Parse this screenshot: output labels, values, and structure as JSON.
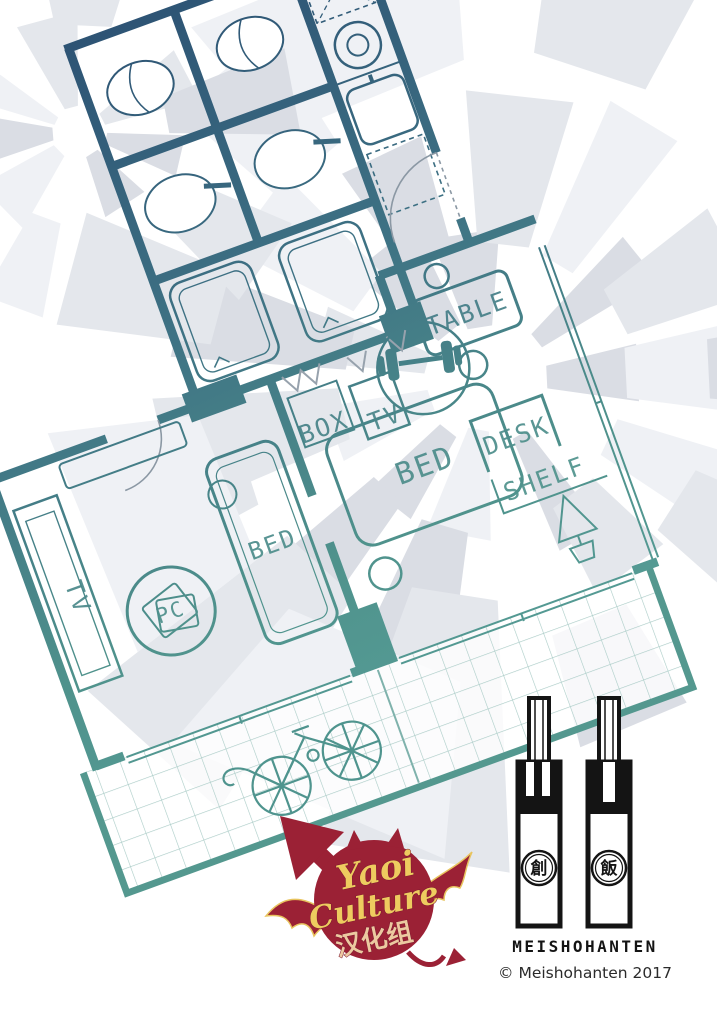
{
  "page": {
    "background": "#ffffff"
  },
  "background": {
    "colors": [
      "#eff1f5",
      "#e4e7ec",
      "#dadde4"
    ],
    "pinwheels": [
      {
        "cx": 488,
        "cy": 380,
        "rings": [
          [
            60,
            175,
            11
          ],
          [
            150,
            300,
            13
          ],
          [
            250,
            450,
            11
          ],
          [
            340,
            540,
            8
          ]
        ]
      },
      {
        "cx": 78,
        "cy": 132,
        "rings": [
          [
            26,
            110,
            9
          ],
          [
            100,
            235,
            9
          ]
        ]
      }
    ]
  },
  "floorplan": {
    "rotation_deg": -20,
    "colors": {
      "wall_top": "#2d5374",
      "wall_mid": "#3e7284",
      "wall_teal": "#4f928c",
      "wall_bottom": "#5aa39c",
      "balcony_grid": "#a9cbc6",
      "fixture_gray": "#97a2ad"
    },
    "labels": {
      "table": "TABLE",
      "desk": "DESK",
      "shelf": "SHELF",
      "bed": "BED",
      "box": "BOX",
      "tv": "TV",
      "pc": "PC"
    },
    "icons": {
      "toilet": "toilet-bowl-ellipse",
      "basin": "wash-basin-oval",
      "shower": "shower-tray",
      "stove": "burner-circle",
      "sink": "kitchen-sink",
      "dumbbell": "dumbbell",
      "bicycle": "bicycle",
      "plant": "pine-tree-pot",
      "door": "door-swing-arc"
    }
  },
  "logos": {
    "yaoi": {
      "word1": "Yaoi",
      "word2": "Culture",
      "word3": "汉化组",
      "circle_color": "#9b2135",
      "text_color": "#eecb5f"
    },
    "meishohanten": {
      "wordmark": "MEISHOHANTEN",
      "copyright": "© Meishohanten 2017",
      "seal_left": "創",
      "seal_right": "飯",
      "ink_color": "#141414"
    }
  }
}
